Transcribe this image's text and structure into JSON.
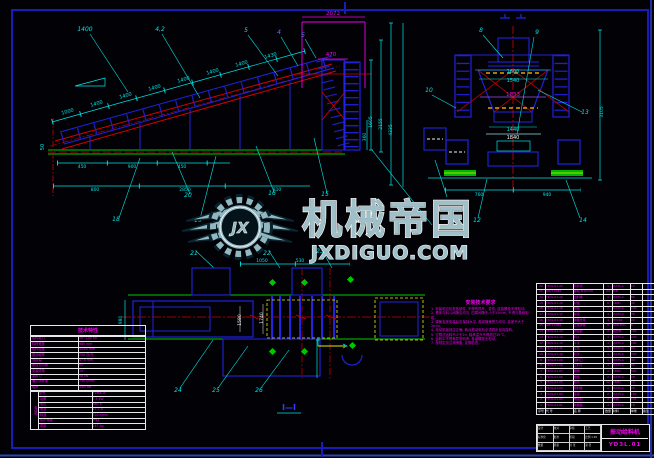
{
  "watermark": {
    "title": "机械帝国",
    "domain": "JXDIGUO.COM",
    "initials": "JX",
    "steel_color": "#93b7c0",
    "outline_color": "#ffffff"
  },
  "section_label": "Ⅰ—Ⅰ",
  "spec_table": {
    "title": "技术特性",
    "rows": [
      [
        "给料能力",
        "50~100 t/h"
      ],
      [
        "料槽宽度",
        "980 mm"
      ],
      [
        "给料粒度",
        "≤350 mm"
      ],
      [
        "振动频率",
        "730 次/分"
      ],
      [
        "双振幅",
        "4~6 mm"
      ],
      [
        "振动方向角",
        "60°"
      ],
      [
        "安装倾角",
        "10°"
      ],
      [
        "激振力",
        "58 kN"
      ],
      [
        "偏心块转速",
        "730 r/min"
      ],
      [
        "噪声",
        "≤85 dB"
      ]
    ],
    "motor_label": "电动机",
    "motor_rows": [
      [
        "型号",
        "Y160L-8"
      ],
      [
        "功率",
        "7.5 kW"
      ],
      [
        "电压",
        "380 V"
      ],
      [
        "电流",
        "17.7 A"
      ],
      [
        "转速",
        "720 r/min"
      ],
      [
        "防护等级",
        "IP44"
      ],
      [
        "质量",
        "147 kg"
      ]
    ]
  },
  "notes": {
    "title": "安装技术要求",
    "lines": [
      "1. 安装前应检查各部件, 不得有损坏、变形, 连接螺栓不得松动。",
      "2. 槽体与料斗间隙应均匀, 四周间隙不小于25mm, 不得与基础相碰。",
      "3. 弹簧支座安装后应保持水平, 各组弹簧受力均匀, 高差不大于2mm。",
      "4. 电动机接线应正确, 两台振动电机必须同步反向旋转。",
      "5. 空载试运转不少于2h, 轴承温升不得超过35℃。",
      "6. 运转中不得有异常响声, 各部螺栓无松动。",
      "7. 按规定加注润滑脂, 定期检查。"
    ]
  },
  "bom": {
    "rows": [
      [
        "22",
        "YD3L.01-22",
        "防护罩",
        "1",
        "Q235-A",
        "12",
        ""
      ],
      [
        "21",
        "GB/T 5782",
        "螺栓 M16×50",
        "24",
        "8.8",
        "",
        ""
      ],
      [
        "20",
        "YD3L.01-20",
        "出料槽",
        "1",
        "Q235-A",
        "86",
        ""
      ],
      [
        "19",
        "YD3L.01-19",
        "衬板",
        "6",
        "16Mn",
        "45",
        ""
      ],
      [
        "18",
        "YD3L.01-18",
        "侧板",
        "2",
        "Q235-A",
        "120",
        ""
      ],
      [
        "17",
        "YD3L.01-17",
        "横梁",
        "3",
        "Q235-A",
        "38",
        ""
      ],
      [
        "16",
        "YD3L.01-16",
        "弹簧支座",
        "4",
        "HT200",
        "22",
        ""
      ],
      [
        "15",
        "GB/T 2089",
        "压缩弹簧",
        "8",
        "60Si2Mn",
        "6",
        ""
      ],
      [
        "14",
        "YD3L.01-14",
        "激振器",
        "2",
        "组合件",
        "160",
        ""
      ],
      [
        "13",
        "YD3L.01-13",
        "料斗",
        "1",
        "Q235-A",
        "240",
        ""
      ],
      [
        "12",
        "YD3L.01-12",
        "斗架",
        "1",
        "Q235-A",
        "180",
        ""
      ],
      [
        "11",
        "YD3L.01-11",
        "立柱",
        "4",
        "Q235-A",
        "64",
        ""
      ],
      [
        "10",
        "YD3L.01-10",
        "机架",
        "1",
        "Q235-A",
        "320",
        ""
      ],
      [
        "9",
        "YD3L.01-09",
        "进料口",
        "1",
        "Q235-A",
        "30",
        ""
      ],
      [
        "8",
        "YD3L.01-08",
        "上料斗",
        "1",
        "Q235-A",
        "95",
        ""
      ],
      [
        "7",
        "YD3L.01-07",
        "槽体",
        "1",
        "16Mn",
        "560",
        ""
      ],
      [
        "6",
        "YD3L.01-06",
        "端板",
        "2",
        "Q235-A",
        "28",
        ""
      ],
      [
        "5",
        "YD3L.01-05",
        "格条",
        "12",
        "16Mn",
        "14",
        ""
      ],
      [
        "4",
        "YD3L.01-04",
        "导料板",
        "2",
        "Q235-A",
        "26",
        ""
      ],
      [
        "3",
        "YD3L.01-03",
        "底座",
        "2",
        "Q235-A",
        "150",
        ""
      ],
      [
        "2",
        "YD3L.01-02",
        "电动机",
        "2",
        "外购",
        "147",
        ""
      ],
      [
        "1",
        "YD3L.01-01",
        "地脚板",
        "4",
        "Q235-A",
        "18",
        ""
      ],
      [
        "序号",
        "代  号",
        "名  称",
        "数量",
        "材料",
        "单重",
        "备注"
      ]
    ]
  },
  "title_block": {
    "name": "振动给料机",
    "drawing_no": "YD3L.01",
    "grid_rows": [
      [
        "设计",
        "校对",
        "审核",
        "工艺"
      ],
      [
        "标准化",
        "批准",
        "阶段",
        "比例 1:20"
      ],
      [
        "数量",
        "质量",
        "共 张",
        "第 张"
      ]
    ]
  },
  "cad_labels": [
    {
      "t": "1400",
      "x": 85,
      "y": 31,
      "c": "#00e5e5",
      "s": 6,
      "i": 1
    },
    {
      "t": "4,2",
      "x": 160,
      "y": 31,
      "c": "#00e5e5",
      "s": 6,
      "i": 1
    },
    {
      "t": "5",
      "x": 246,
      "y": 32,
      "c": "#00e5e5",
      "s": 6,
      "i": 1
    },
    {
      "t": "4",
      "x": 279,
      "y": 34,
      "c": "#4d7dff",
      "s": 6,
      "i": 1
    },
    {
      "t": "5",
      "x": 303,
      "y": 37,
      "c": "#4d7dff",
      "s": 6,
      "i": 1
    },
    {
      "t": "1000",
      "x": 68,
      "y": 113,
      "c": "#00e5e5",
      "s": 5,
      "r": -16
    },
    {
      "t": "1400",
      "x": 97,
      "y": 105,
      "c": "#00e5e5",
      "s": 5,
      "r": -16
    },
    {
      "t": "1400",
      "x": 126,
      "y": 97,
      "c": "#00e5e5",
      "s": 5,
      "r": -16
    },
    {
      "t": "1400",
      "x": 155,
      "y": 89,
      "c": "#00e5e5",
      "s": 5,
      "r": -16
    },
    {
      "t": "1400",
      "x": 184,
      "y": 81,
      "c": "#00e5e5",
      "s": 5,
      "r": -16
    },
    {
      "t": "1400",
      "x": 213,
      "y": 73,
      "c": "#00e5e5",
      "s": 5,
      "r": -16
    },
    {
      "t": "1400",
      "x": 242,
      "y": 65,
      "c": "#00e5e5",
      "s": 5,
      "r": -16
    },
    {
      "t": "1430",
      "x": 271,
      "y": 57,
      "c": "#00e5e5",
      "s": 5,
      "r": -16
    },
    {
      "t": "50",
      "x": 44,
      "y": 147,
      "c": "#00e5e5",
      "s": 5,
      "r": -90
    },
    {
      "t": "450",
      "x": 82,
      "y": 168,
      "c": "#00e5e5",
      "s": 4.5
    },
    {
      "t": "900",
      "x": 132,
      "y": 168,
      "c": "#00e5e5",
      "s": 4.5
    },
    {
      "t": "450",
      "x": 182,
      "y": 168,
      "c": "#00e5e5",
      "s": 4.5
    },
    {
      "t": "800",
      "x": 95,
      "y": 191,
      "c": "#00e5e5",
      "s": 4.5
    },
    {
      "t": "2850",
      "x": 185,
      "y": 191,
      "c": "#00e5e5",
      "s": 4.5
    },
    {
      "t": "810",
      "x": 277,
      "y": 191,
      "c": "#00e5e5",
      "s": 4.5
    },
    {
      "t": "2072",
      "x": 333,
      "y": 15,
      "c": "#ee00ee",
      "s": 5.5
    },
    {
      "t": "470",
      "x": 331,
      "y": 56,
      "c": "#ee00ee",
      "s": 5.5
    },
    {
      "t": "360",
      "x": 366,
      "y": 137,
      "c": "#00e5e5",
      "s": 4.5,
      "r": -90
    },
    {
      "t": "1605",
      "x": 372,
      "y": 122,
      "c": "#00e5e5",
      "s": 4.5,
      "r": -90
    },
    {
      "t": "2155",
      "x": 382,
      "y": 124,
      "c": "#00e5e5",
      "s": 4.5,
      "r": -90
    },
    {
      "t": "4335",
      "x": 392,
      "y": 130,
      "c": "#00e5e5",
      "s": 4.5,
      "r": -90
    },
    {
      "t": "1600",
      "x": 513,
      "y": 73,
      "c": "#00e5e5",
      "s": 5
    },
    {
      "t": "1540",
      "x": 513,
      "y": 82,
      "c": "#00e5e5",
      "s": 5
    },
    {
      "t": "1833",
      "x": 513,
      "y": 96,
      "c": "#ee00ee",
      "s": 5.5
    },
    {
      "t": "1440",
      "x": 513,
      "y": 131,
      "c": "#00e5e5",
      "s": 5
    },
    {
      "t": "1840",
      "x": 513,
      "y": 139,
      "c": "#f2f2f2",
      "s": 5
    },
    {
      "t": "760",
      "x": 479,
      "y": 196,
      "c": "#00e5e5",
      "s": 4.5
    },
    {
      "t": "940",
      "x": 547,
      "y": 196,
      "c": "#00e5e5",
      "s": 4.5
    },
    {
      "t": "3105",
      "x": 603,
      "y": 112,
      "c": "#00e5e5",
      "s": 4.5,
      "r": -90
    },
    {
      "t": "8",
      "x": 481,
      "y": 32,
      "c": "#00e5e5",
      "s": 6,
      "i": 1
    },
    {
      "t": "9",
      "x": 537,
      "y": 34,
      "c": "#00e5e5",
      "s": 6,
      "i": 1
    },
    {
      "t": "10",
      "x": 429,
      "y": 92,
      "c": "#00e5e5",
      "s": 6,
      "i": 1
    },
    {
      "t": "13",
      "x": 585,
      "y": 114,
      "c": "#00e5e5",
      "s": 6,
      "i": 1
    },
    {
      "t": "12",
      "x": 477,
      "y": 222,
      "c": "#00e5e5",
      "s": 6,
      "i": 1
    },
    {
      "t": "14",
      "x": 583,
      "y": 222,
      "c": "#00e5e5",
      "s": 6,
      "i": 1
    },
    {
      "t": "18",
      "x": 116,
      "y": 221,
      "c": "#00e5e5",
      "s": 6,
      "i": 1
    },
    {
      "t": "19",
      "x": 198,
      "y": 222,
      "c": "#00e5e5",
      "s": 6,
      "i": 1
    },
    {
      "t": "20",
      "x": 188,
      "y": 197,
      "c": "#00e5e5",
      "s": 6,
      "i": 1
    },
    {
      "t": "16",
      "x": 272,
      "y": 195,
      "c": "#00e5e5",
      "s": 6,
      "i": 1
    },
    {
      "t": "15",
      "x": 325,
      "y": 196,
      "c": "#00e5e5",
      "s": 6,
      "i": 1
    },
    {
      "t": "21",
      "x": 194,
      "y": 255,
      "c": "#00e5e5",
      "s": 6,
      "i": 1
    },
    {
      "t": "22",
      "x": 267,
      "y": 255,
      "c": "#00e5e5",
      "s": 6,
      "i": 1
    },
    {
      "t": "23",
      "x": 320,
      "y": 253,
      "c": "#00e5e5",
      "s": 6,
      "i": 1
    },
    {
      "t": "24",
      "x": 178,
      "y": 392,
      "c": "#00e5e5",
      "s": 6,
      "i": 1
    },
    {
      "t": "25",
      "x": 216,
      "y": 392,
      "c": "#00e5e5",
      "s": 6,
      "i": 1
    },
    {
      "t": "26",
      "x": 259,
      "y": 392,
      "c": "#00e5e5",
      "s": 6,
      "i": 1
    },
    {
      "t": "980",
      "x": 122,
      "y": 320,
      "c": "#00e5e5",
      "s": 4.5,
      "r": -90
    },
    {
      "t": "1580",
      "x": 241,
      "y": 320,
      "c": "#f2f2f2",
      "s": 4.5,
      "r": -90
    },
    {
      "t": "1740",
      "x": 263,
      "y": 318,
      "c": "#f2f2f2",
      "s": 4.5,
      "r": -90
    },
    {
      "t": "1050",
      "x": 262,
      "y": 262,
      "c": "#00e5e5",
      "s": 4.5
    },
    {
      "t": "530",
      "x": 300,
      "y": 262,
      "c": "#00e5e5",
      "s": 4.5
    }
  ]
}
